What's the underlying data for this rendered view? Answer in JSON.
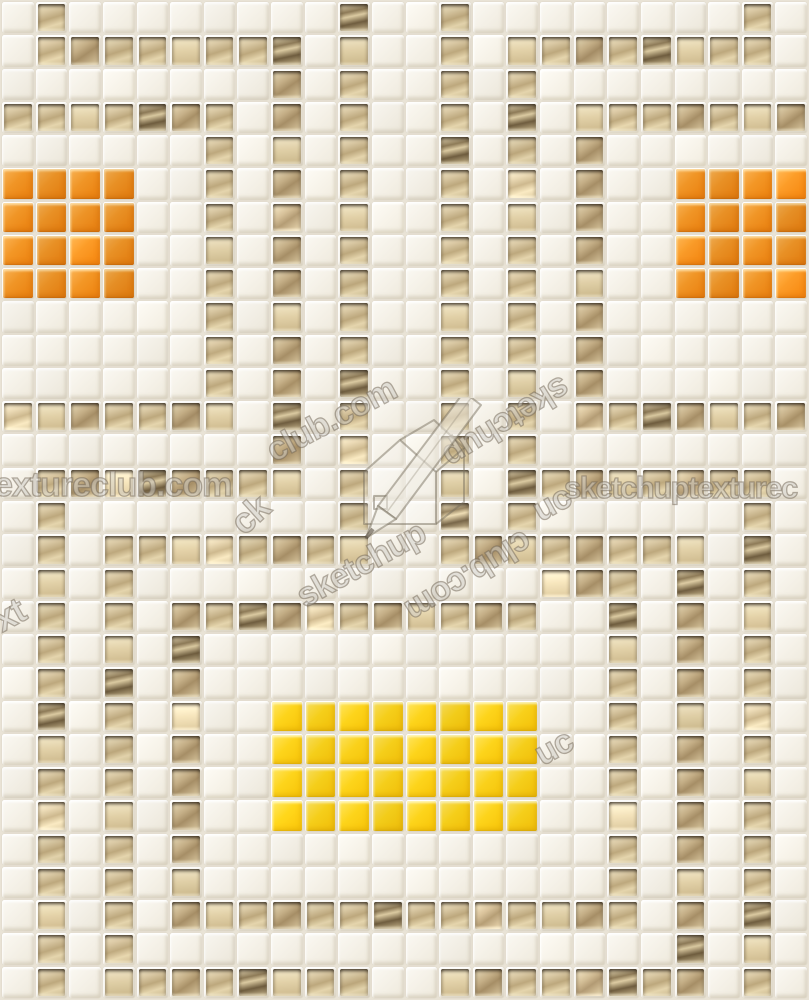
{
  "image": {
    "description": "White ceramic square mosaic tile texture with champagne-gold metallic accent lines, two orange 4x4 tile blocks and one yellow 8x4 tile block",
    "grid": {
      "cols": 24,
      "rows": 30,
      "cell_legend": {
        "W": "white",
        "M": "gold-metallic",
        "O": "orange",
        "Y": "yellow"
      },
      "rows_map": [
        "WMWWWWWWWWMWWMWWWWWWWWMW",
        "WMMMMMMMMWMWWMWMMMMMMMMW",
        "WWWWWWWWMWMWWMWMWWWWWWWW",
        "MMMMMMMWMWMWWMWMWMMMMMMM",
        "WWWWWWMWMWMWWMWMWMWWWWWW",
        "OOOOWWMWMWMWWMWMWMWWOOOO",
        "OOOOWWMWMWMWWMWMWMWWOOOO",
        "OOOOWWMWMWMWWMWMWMWWOOOO",
        "OOOOWWMWMWMWWMWMWMWWOOOO",
        "WWWWWWMWMWMWWMWMWMWWWWWW",
        "WWWWWWMWMWMWWMWMWMWWWWWW",
        "WWWWWWMWMWMWWMWMWMWWWWWW",
        "MMMMMMMWMWMWWMWMWMMMMMMM",
        "WWWWWWWWMWMWWMWMWWWWWWWW",
        "WMMMMMMMMWMWWMWMMMMMMMMW",
        "WMWWWWWWWWMWWMWMWWWWWWMW",
        "WMWMMMMMMMMWWMMMMMMMMWMW",
        "WMWMWWWWWWWWWWWWMMMWMWMW",
        "WMWMWMMMMMMMMMMMWWMWMWMW",
        "WMWMWMWWWWWWWWWWWWMWMWMW",
        "WMWMWMWWWWWWWWWWWWMWMWMW",
        "WMWMWMWWYYYYYYYYWWMWMWMW",
        "WMWMWMWWYYYYYYYYWWMWMWMW",
        "WMWMWMWWYYYYYYYYWWMWMWMW",
        "WMWMWMWWYYYYYYYYWWMWMWMW",
        "WMWMWMWWWWWWWWWWWWMWMWMW",
        "WMWMWMWWWWWWWWWWWWMWMWMW",
        "WMWMWMMMMMMMMMMMMMMWMWMW",
        "WMWMWWWWWWWWWWWWWWWWMWMW",
        "WMWMMMMMMMMWWMMMMMMMMWMW"
      ]
    },
    "colors": {
      "grout": "#e9e3d6",
      "white_tile": "#f4f0e6",
      "metallic_gold": "#d9c8a3",
      "metallic_edge": "#2c2114",
      "orange": "#f09526",
      "yellow": "#fdd41b"
    },
    "watermark": {
      "text": "sketchuptextureclub.com",
      "logo": "sketchup-texture-club-pencil-house-logo",
      "fragments": [
        {
          "id": "left-horizontal",
          "text": "extureclub.com"
        },
        {
          "id": "right-horizontal",
          "text": "sketchuptexturec"
        },
        {
          "id": "diag-upper-left",
          "text": "club.com"
        },
        {
          "id": "diag-upper-right",
          "text": "sketchup"
        },
        {
          "id": "diag-lower-left",
          "text": "sketchup"
        },
        {
          "id": "diag-lower-right",
          "text": "club.com"
        },
        {
          "id": "edge-left-lower",
          "text": "xt"
        },
        {
          "id": "edge-left-mid",
          "text": "ck"
        },
        {
          "id": "edge-right-mid",
          "text": "uc"
        },
        {
          "id": "edge-right-low",
          "text": "uc"
        }
      ]
    }
  }
}
